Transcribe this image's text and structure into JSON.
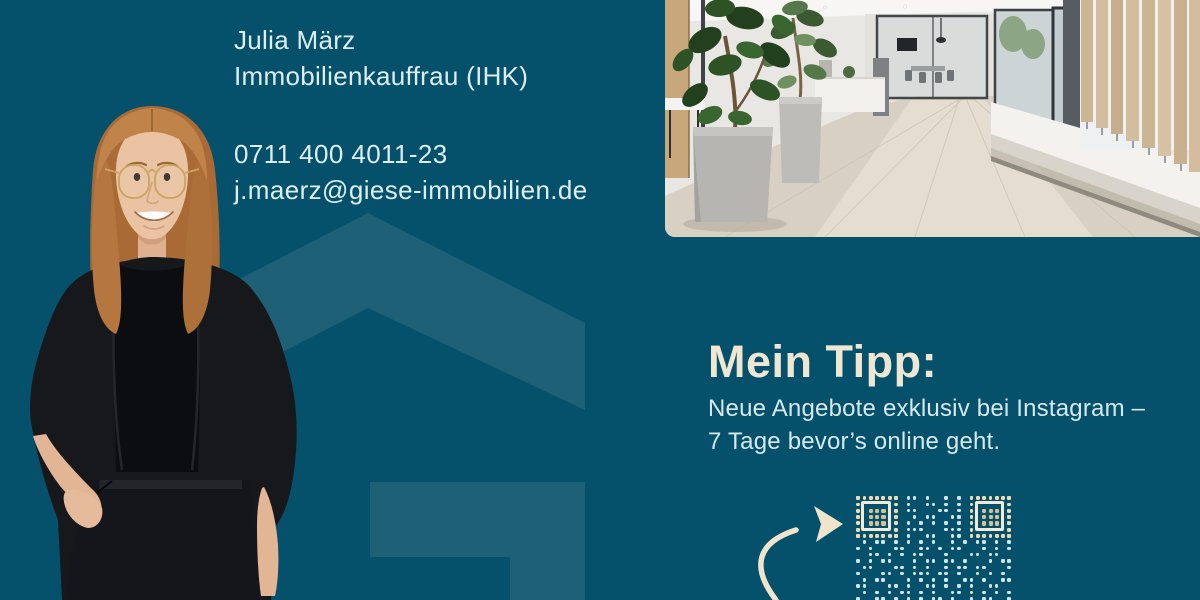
{
  "agent": {
    "name": "Julia März",
    "role": "Immobilienkauffrau (IHK)",
    "phone": "0711 400 4011-23",
    "email": "j.maerz@giese-immobilien.de"
  },
  "tip": {
    "heading": "Mein Tipp:",
    "line1": "Neue Angebote exklusiv bei Instagram –",
    "line2": "7 Tage bevor’s online geht."
  },
  "icons": {
    "arrow": "hand-drawn-curved-arrow",
    "watermark": "house-roof-logo",
    "qr": "stylized-dotted-qr-code"
  },
  "colors": {
    "bg": "#05506a",
    "wm": "#1e6177",
    "text": "#ddeef1",
    "body": "#d6e9ec",
    "cream": "#f0e7d3",
    "qrdot": "#cfe4e8",
    "qrcream": "#e9dbb6",
    "qrcream2": "#f2ead6",
    "qrtan": "#d8c093"
  },
  "qr": {
    "module_px": 6.3,
    "finder_cols": [
      0,
      18
    ],
    "rows": [
      "........11.1..1.1........",
      "........1..11.1.1........",
      "........11...11.1........",
      ".........1.11..11........",
      "........1.1.1.1.1........",
      "........111...111........",
      "........1..11..11........",
      ".1.11.1.1.1.1..1.1.11.1.1",
      "1.1...11..11.1.11...1.1.1",
      "..11.1.1.11...1...11.11..",
      "1.1.11...1.11.11.1...1.11",
      ".11...11.1.1..1.11.11...1",
      "1...11.1.111.11.1..2.1.1.",
      ".1.11...1.1.1.1..11.1..11",
      "11...11.1..11.1.1.1..11..",
      ".1.1.1.11.1.1..11.2.1.1.1",
      "1..11.1.1.1.11.1..1.11..1"
    ]
  }
}
